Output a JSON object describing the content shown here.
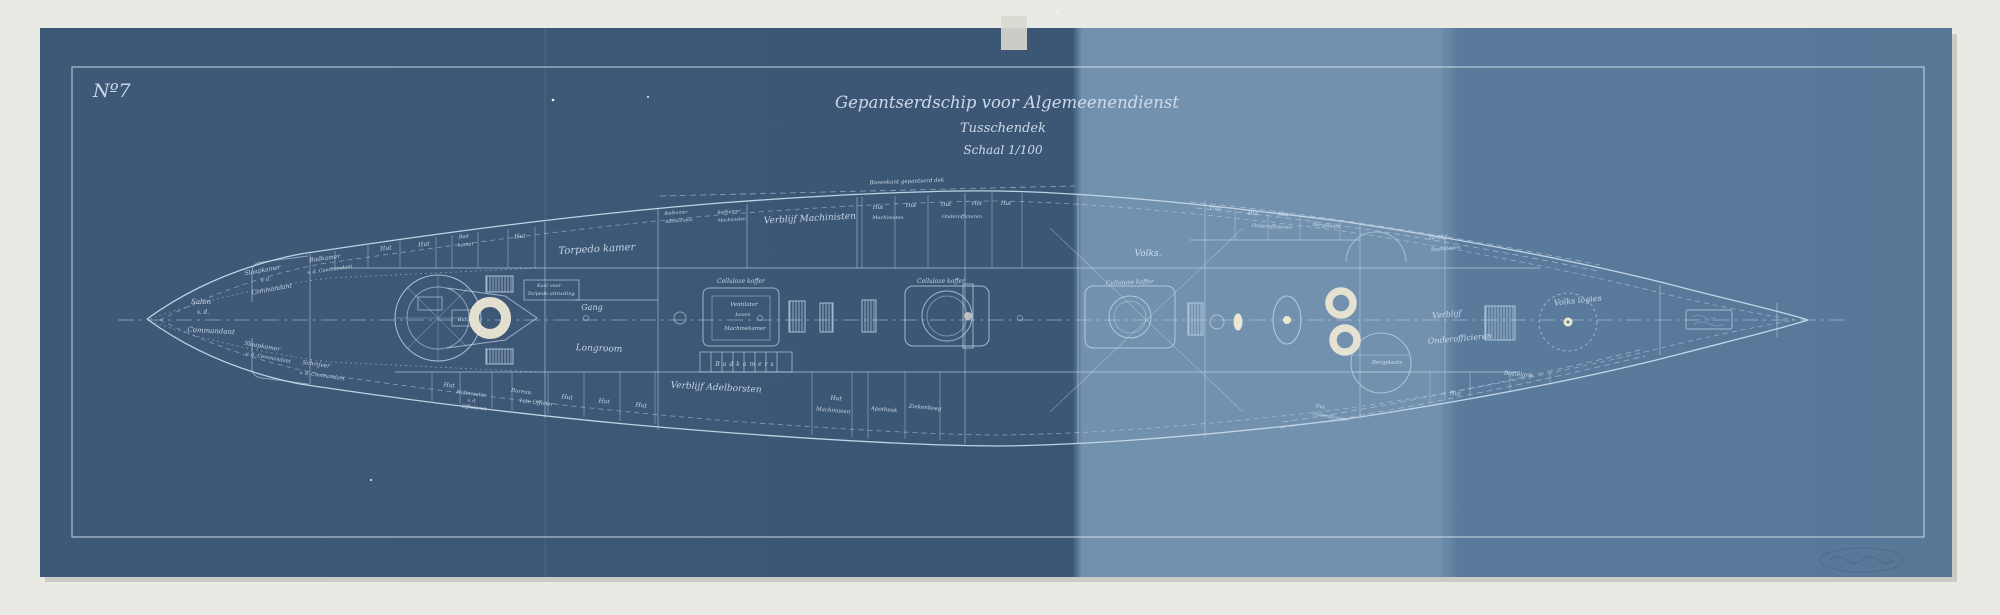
{
  "scene": {
    "background_color": "#e9eae3",
    "paper_dark": "#3e5878",
    "paper_band": "#7291af",
    "paper_right": "#5a7a9c",
    "line_color": "#c6d9ea",
    "bright_color": "#ece7d3"
  },
  "corner_mark": "Nº7",
  "title": {
    "line1": "Gepantserdschip voor Algemeenendienst",
    "line2": "Tusschendek",
    "line3": "Schaal 1/100"
  },
  "ship": {
    "labels": [
      {
        "t": "Slaapkamer",
        "x": 263,
        "y": 272,
        "s": 6,
        "r": -10
      },
      {
        "t": "v. d.",
        "x": 266,
        "y": 281,
        "s": 5,
        "r": -10
      },
      {
        "t": "Commandant",
        "x": 272,
        "y": 291,
        "s": 6,
        "r": -10
      },
      {
        "t": "Badkamer",
        "x": 325,
        "y": 260,
        "s": 6,
        "r": -8
      },
      {
        "t": "v. d. Commandant",
        "x": 330,
        "y": 271,
        "s": 5,
        "r": -8
      },
      {
        "t": "Salon",
        "x": 201,
        "y": 304,
        "s": 7,
        "r": 0
      },
      {
        "t": "v. d.",
        "x": 203,
        "y": 314,
        "s": 6,
        "r": 0
      },
      {
        "t": "Commandant",
        "x": 211,
        "y": 333,
        "s": 7,
        "r": 3
      },
      {
        "t": "Slaapkamer",
        "x": 262,
        "y": 348,
        "s": 6,
        "r": 10
      },
      {
        "t": "v. d. Commandant",
        "x": 268,
        "y": 359,
        "s": 5,
        "r": 10
      },
      {
        "t": "Schrijver",
        "x": 316,
        "y": 366,
        "s": 6,
        "r": 8
      },
      {
        "t": "v. d. Commandant",
        "x": 322,
        "y": 377,
        "s": 5,
        "r": 8
      },
      {
        "t": "Hut",
        "x": 386,
        "y": 250,
        "s": 6,
        "r": -6
      },
      {
        "t": "Hut",
        "x": 424,
        "y": 246,
        "s": 6,
        "r": -6
      },
      {
        "t": "Bad",
        "x": 464,
        "y": 238,
        "s": 5,
        "r": -6
      },
      {
        "t": "kamer",
        "x": 466,
        "y": 246,
        "s": 5,
        "r": -6
      },
      {
        "t": "Hut",
        "x": 520,
        "y": 238,
        "s": 6,
        "r": -5
      },
      {
        "t": "Torpedo kamer",
        "x": 597,
        "y": 252,
        "s": 10,
        "r": -3
      },
      {
        "t": "Kast voor",
        "x": 549,
        "y": 287,
        "s": 5,
        "r": 0
      },
      {
        "t": "Torpedo uitrusting",
        "x": 551,
        "y": 295,
        "s": 5,
        "r": 0
      },
      {
        "t": "Gang",
        "x": 592,
        "y": 310,
        "s": 8,
        "r": 0
      },
      {
        "t": "Longroom",
        "x": 599,
        "y": 351,
        "s": 9,
        "r": 2
      },
      {
        "t": "Hut",
        "x": 462,
        "y": 321,
        "s": 4.5,
        "r": 0
      },
      {
        "t": "Hut",
        "x": 449,
        "y": 387,
        "s": 6,
        "r": 7
      },
      {
        "t": "Hofmeester",
        "x": 471,
        "y": 395,
        "s": 5,
        "r": 7
      },
      {
        "t": "v. d.",
        "x": 472,
        "y": 402,
        "s": 4.5,
        "r": 7
      },
      {
        "t": "Officieren",
        "x": 474,
        "y": 409,
        "s": 5,
        "r": 7
      },
      {
        "t": "Bureau",
        "x": 521,
        "y": 393,
        "s": 5.5,
        "r": 7
      },
      {
        "t": "1ste Officier",
        "x": 536,
        "y": 404,
        "s": 5.5,
        "r": 7
      },
      {
        "t": "Hut",
        "x": 567,
        "y": 399,
        "s": 6,
        "r": 7
      },
      {
        "t": "Hut",
        "x": 604,
        "y": 403,
        "s": 6,
        "r": 7
      },
      {
        "t": "Hut",
        "x": 641,
        "y": 407,
        "s": 6,
        "r": 8
      },
      {
        "t": "Verblijf Adelborsten",
        "x": 716,
        "y": 390,
        "s": 9,
        "r": 3
      },
      {
        "t": "Badkamers",
        "x": 746,
        "y": 366,
        "s": 6,
        "r": 0,
        "ls": 3
      },
      {
        "t": "Badkamer",
        "x": 676,
        "y": 214,
        "s": 4.5,
        "r": -4
      },
      {
        "t": "Adelborsten",
        "x": 679,
        "y": 222,
        "s": 4.5,
        "r": -4
      },
      {
        "t": "Badkamer",
        "x": 729,
        "y": 213,
        "s": 4.5,
        "r": -4
      },
      {
        "t": "Machinisten",
        "x": 732,
        "y": 221,
        "s": 4.5,
        "r": -4
      },
      {
        "t": "Verblijf Machinisten",
        "x": 810,
        "y": 221,
        "s": 9,
        "r": -3
      },
      {
        "t": "Celluloze koffer",
        "x": 741,
        "y": 283,
        "s": 6,
        "r": 0
      },
      {
        "t": "Ventilator",
        "x": 744,
        "y": 306,
        "s": 5.5,
        "r": 0
      },
      {
        "t": "boven",
        "x": 743,
        "y": 316,
        "s": 5,
        "r": 0
      },
      {
        "t": "Machinekamer",
        "x": 745,
        "y": 330,
        "s": 5.5,
        "r": 0
      },
      {
        "t": "Celluloze koffer",
        "x": 941,
        "y": 283,
        "s": 6,
        "r": 0
      },
      {
        "t": "Bovenkant gepantserd dek",
        "x": 907,
        "y": 183,
        "s": 5.5,
        "r": -2
      },
      {
        "t": "Hut",
        "x": 878,
        "y": 209,
        "s": 5.5,
        "r": 0
      },
      {
        "t": "Hut",
        "x": 911,
        "y": 207,
        "s": 5.5,
        "r": 0
      },
      {
        "t": "Hut",
        "x": 946,
        "y": 206,
        "s": 5.5,
        "r": 0
      },
      {
        "t": "Hut",
        "x": 977,
        "y": 205,
        "s": 5.5,
        "r": 0
      },
      {
        "t": "Hut",
        "x": 1006,
        "y": 205,
        "s": 5.5,
        "r": 0
      },
      {
        "t": "Machinisten",
        "x": 888,
        "y": 219,
        "s": 5,
        "r": 0
      },
      {
        "t": "Onderofficieren",
        "x": 962,
        "y": 218,
        "s": 5,
        "r": 0
      },
      {
        "t": "Hut",
        "x": 836,
        "y": 400,
        "s": 6,
        "r": 5
      },
      {
        "t": "Machinisten",
        "x": 833,
        "y": 412,
        "s": 5.5,
        "r": 5
      },
      {
        "t": "Apotheek",
        "x": 884,
        "y": 411,
        "s": 5.5,
        "r": 5
      },
      {
        "t": "Ziekenboeg",
        "x": 925,
        "y": 409,
        "s": 5.5,
        "r": 5
      },
      {
        "t": "Volks.",
        "x": 1148,
        "y": 256,
        "s": 9,
        "r": 0
      },
      {
        "t": "Celluloze koffer",
        "x": 1130,
        "y": 284,
        "s": 6,
        "r": -2
      },
      {
        "t": "Trap",
        "x": 1215,
        "y": 210,
        "s": 5,
        "r": 0
      },
      {
        "t": "Hut",
        "x": 1253,
        "y": 215,
        "s": 5.5,
        "r": 3
      },
      {
        "t": "Hut",
        "x": 1283,
        "y": 216,
        "s": 5.5,
        "r": 3
      },
      {
        "t": "Onderofficieren",
        "x": 1272,
        "y": 228,
        "s": 5,
        "r": 3
      },
      {
        "t": "Bergplaats",
        "x": 1326,
        "y": 227,
        "s": 5,
        "r": 5
      },
      {
        "t": "Verblijf",
        "x": 1438,
        "y": 239,
        "s": 5,
        "r": -5
      },
      {
        "t": "Bootslieden",
        "x": 1446,
        "y": 250,
        "s": 5,
        "r": -5
      },
      {
        "t": "Verblijf",
        "x": 1447,
        "y": 317,
        "s": 8,
        "r": -5
      },
      {
        "t": "Onderofficieren",
        "x": 1460,
        "y": 341,
        "s": 8,
        "r": -5
      },
      {
        "t": "Volks logies",
        "x": 1578,
        "y": 303,
        "s": 8,
        "r": -6
      },
      {
        "t": "Bergplaats",
        "x": 1387,
        "y": 364,
        "s": 5.5,
        "r": 0
      },
      {
        "t": "Bottelarij",
        "x": 1518,
        "y": 376,
        "s": 6,
        "r": 5
      },
      {
        "t": "Hut",
        "x": 1320,
        "y": 408,
        "s": 5,
        "r": 10
      },
      {
        "t": "Onderofficieren",
        "x": 1330,
        "y": 418,
        "s": 4.5,
        "r": 10
      },
      {
        "t": "Hut",
        "x": 1455,
        "y": 395,
        "s": 5.5,
        "r": 8
      }
    ]
  }
}
